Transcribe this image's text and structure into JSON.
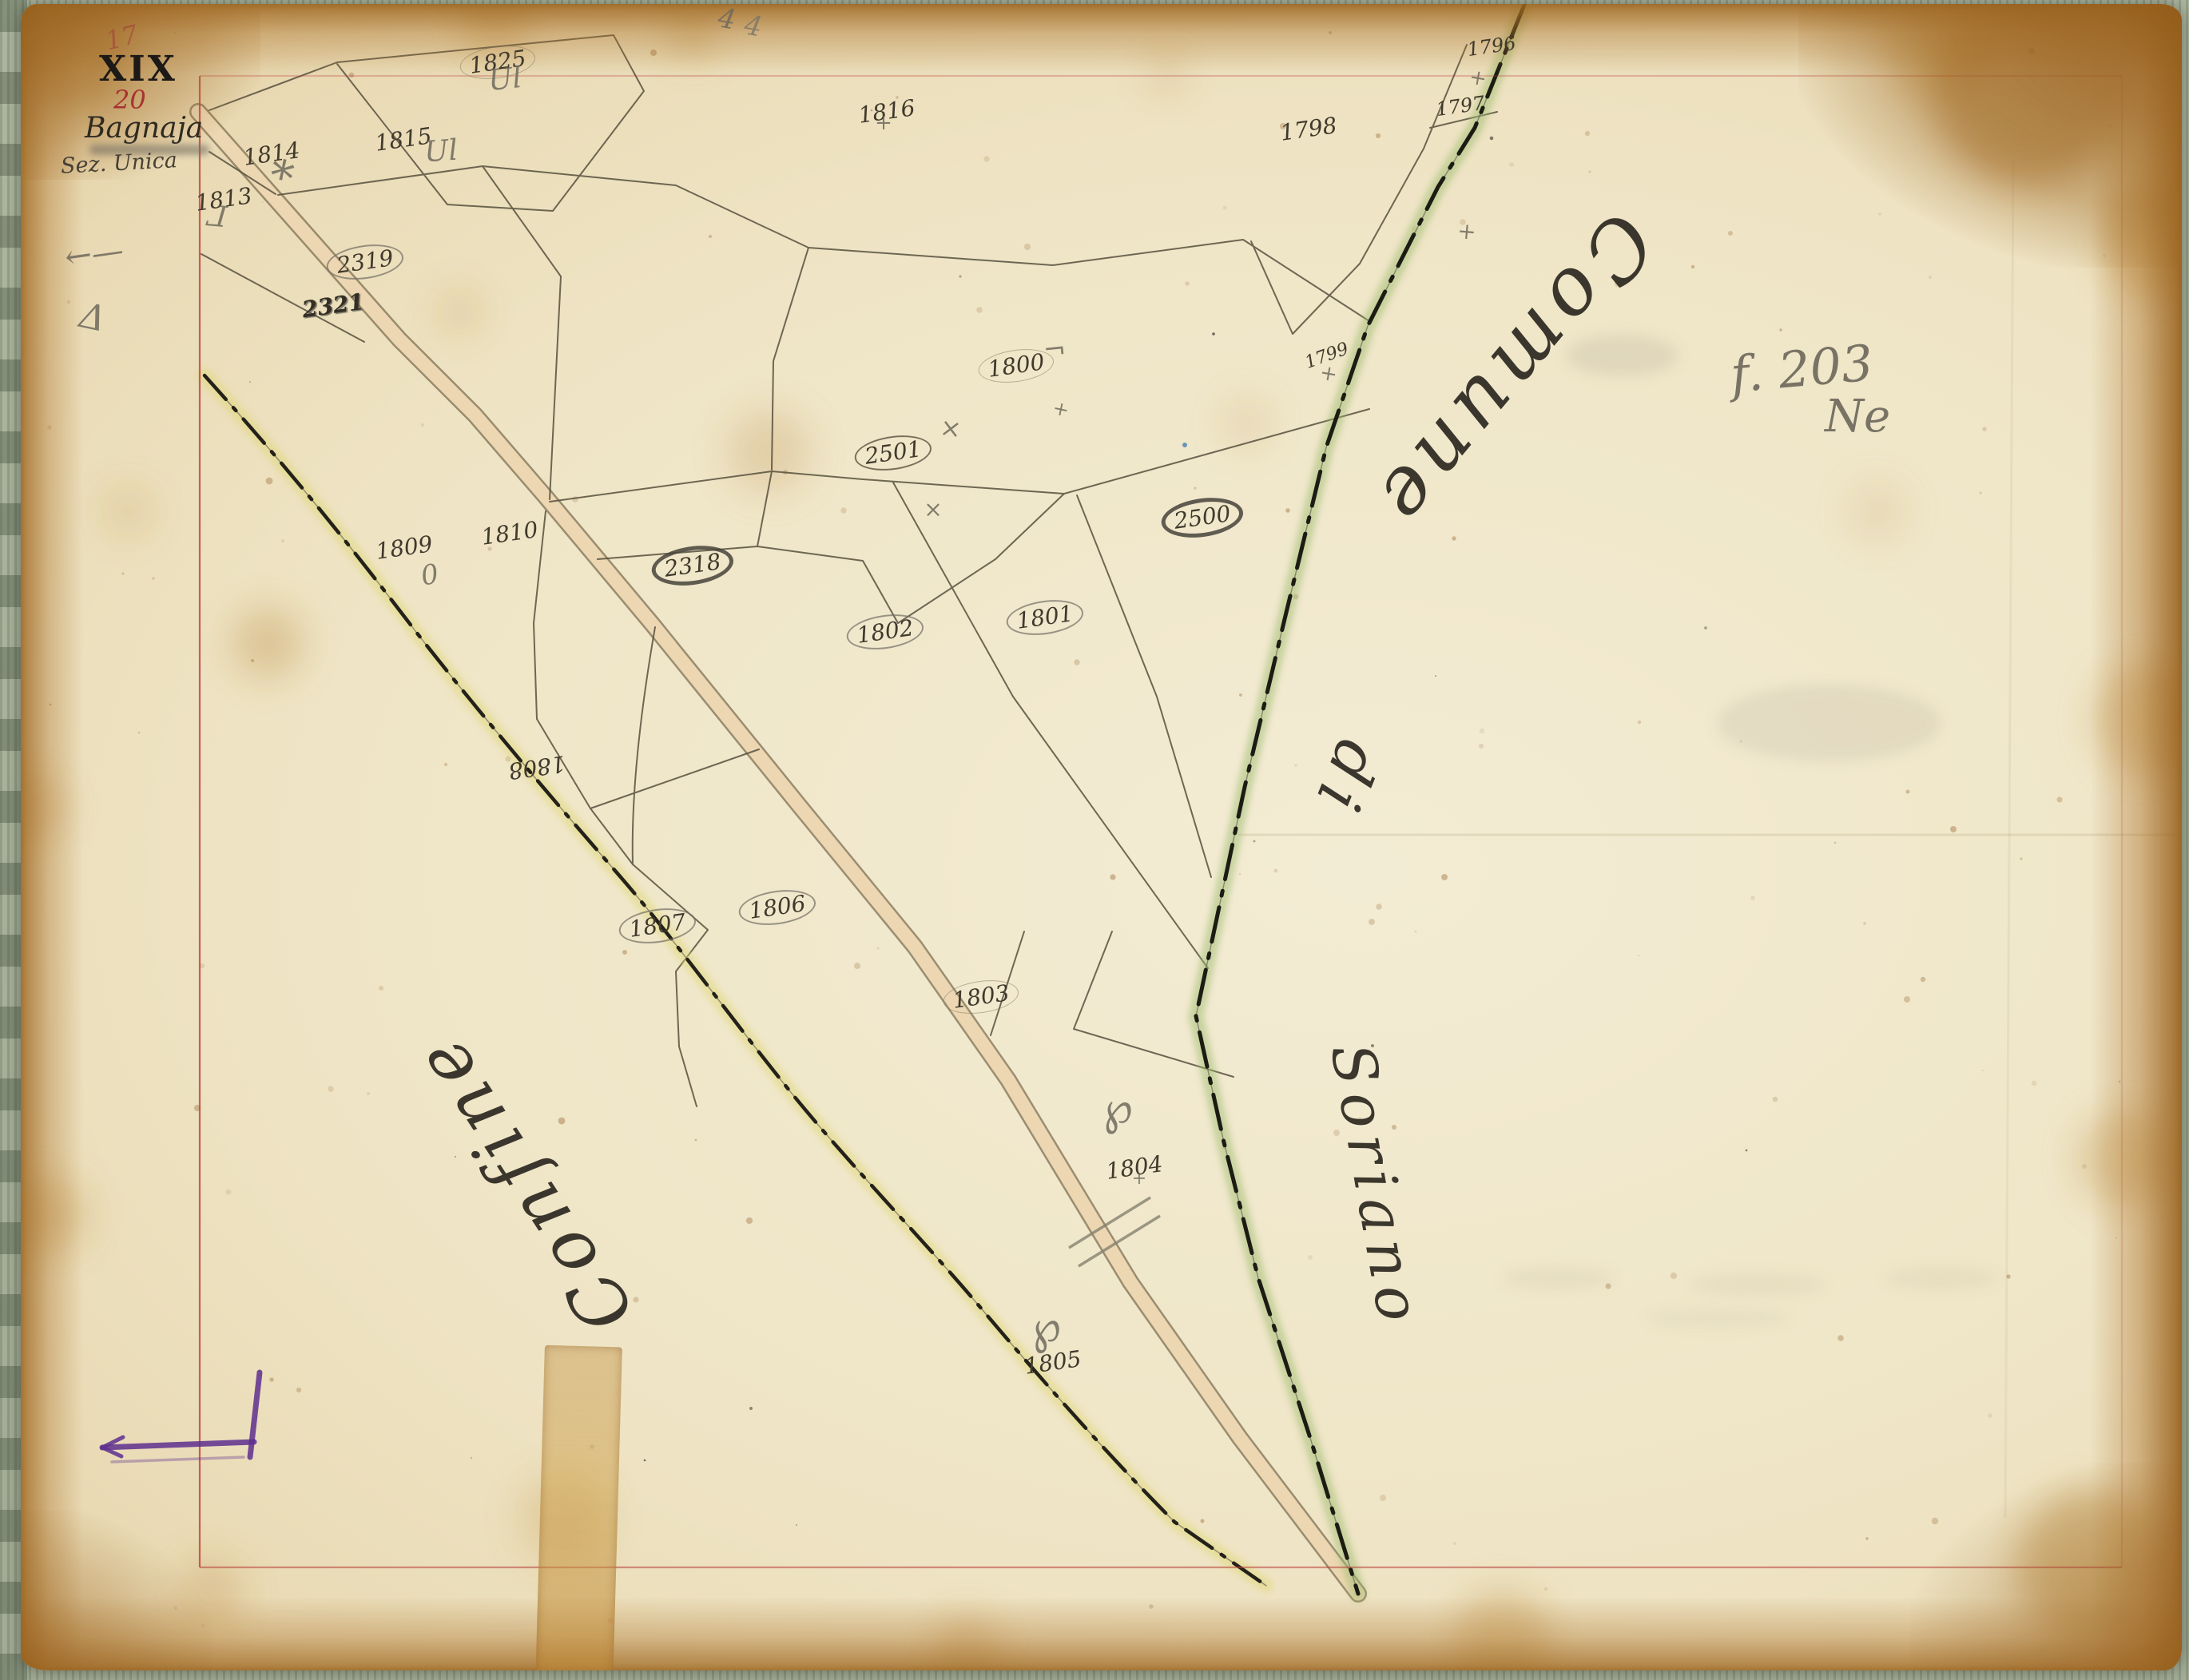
{
  "document_type": "cadastral map sheet (scanned historical document)",
  "corner_block": {
    "folio_number": "17",
    "series": "XIX",
    "sheet_number": "20",
    "title": "Bagnaja",
    "subtitle": "Sez. Unica"
  },
  "notes": {
    "folio_ref": "f. 203",
    "orientation": "Ne",
    "top_edge_mark": "4"
  },
  "map": {
    "territory_labels": [
      {
        "text": "Comune",
        "x": 1895,
        "y": 465,
        "rot": 130,
        "size": 100
      },
      {
        "text": "di",
        "x": 1685,
        "y": 975,
        "rot": 112,
        "size": 78
      },
      {
        "text": "Soriano",
        "x": 1722,
        "y": 1485,
        "rot": 80,
        "size": 74
      },
      {
        "text": "Confine",
        "x": 655,
        "y": 1480,
        "rot": 237,
        "size": 90
      }
    ],
    "parcels": [
      {
        "label": "1825",
        "x": 623,
        "y": 78,
        "circle": "c-ink-faint"
      },
      {
        "label": "1816",
        "x": 1110,
        "y": 140
      },
      {
        "label": "1798",
        "x": 1638,
        "y": 162
      },
      {
        "label": "1796",
        "x": 1867,
        "y": 58,
        "size": 24
      },
      {
        "label": "1797",
        "x": 1828,
        "y": 133,
        "size": 24
      },
      {
        "label": "1799",
        "x": 1661,
        "y": 446,
        "size": 22,
        "rot": -20
      },
      {
        "label": "1800",
        "x": 1272,
        "y": 458,
        "circle": "c-ink-faint"
      },
      {
        "label": "1814",
        "x": 340,
        "y": 193
      },
      {
        "label": "1815",
        "x": 505,
        "y": 175
      },
      {
        "label": "1813",
        "x": 280,
        "y": 250
      },
      {
        "label": "2319",
        "x": 457,
        "y": 328,
        "circle": "c-pencil"
      },
      {
        "label": "2321",
        "x": 417,
        "y": 383,
        "overwritten": true
      },
      {
        "label": "2501",
        "x": 1118,
        "y": 567,
        "circle": "c-ink"
      },
      {
        "label": "2500",
        "x": 1505,
        "y": 648,
        "circle": "c-pencil-dark"
      },
      {
        "label": "1809",
        "x": 506,
        "y": 686
      },
      {
        "label": "1810",
        "x": 638,
        "y": 668
      },
      {
        "label": "2318",
        "x": 867,
        "y": 708,
        "circle": "c-pencil-dark"
      },
      {
        "label": "1802",
        "x": 1108,
        "y": 791,
        "circle": "c-pencil"
      },
      {
        "label": "1801",
        "x": 1308,
        "y": 773,
        "circle": "c-pencil"
      },
      {
        "label": "1808",
        "x": 672,
        "y": 960,
        "rot": 172
      },
      {
        "label": "1807",
        "x": 823,
        "y": 1159,
        "circle": "c-pencil"
      },
      {
        "label": "1806",
        "x": 973,
        "y": 1136,
        "circle": "c-pencil"
      },
      {
        "label": "1803",
        "x": 1228,
        "y": 1248,
        "circle": "c-ink-faint"
      },
      {
        "label": "1804",
        "x": 1420,
        "y": 1462
      },
      {
        "label": "1805",
        "x": 1318,
        "y": 1706
      }
    ],
    "pencil_marks": [
      {
        "type": "asterisk",
        "x": 352,
        "y": 222,
        "size": 58,
        "rot": 12
      },
      {
        "type": "ul",
        "x": 632,
        "y": 100,
        "size": 36,
        "rot": -6
      },
      {
        "type": "ul",
        "x": 552,
        "y": 190,
        "size": 36,
        "rot": -4
      },
      {
        "type": "gamma",
        "x": 272,
        "y": 268,
        "size": 36,
        "rot": 185
      },
      {
        "type": "arrow",
        "x": 118,
        "y": 318,
        "size": 40,
        "rot": -8
      },
      {
        "type": "triangle",
        "x": 116,
        "y": 398,
        "size": 44,
        "rot": 12
      },
      {
        "type": "plus",
        "x": 1106,
        "y": 154,
        "size": 26,
        "rot": 0
      },
      {
        "type": "plus",
        "x": 1850,
        "y": 98,
        "size": 26,
        "rot": 10
      },
      {
        "type": "plus",
        "x": 1836,
        "y": 290,
        "size": 28,
        "rot": 5
      },
      {
        "type": "plus",
        "x": 1663,
        "y": 468,
        "size": 26,
        "rot": 10
      },
      {
        "type": "corner",
        "x": 1320,
        "y": 438,
        "size": 34,
        "rot": -6
      },
      {
        "type": "x",
        "x": 1190,
        "y": 536,
        "size": 32,
        "rot": 8
      },
      {
        "type": "x",
        "x": 1168,
        "y": 638,
        "size": 28,
        "rot": 0
      },
      {
        "type": "plus",
        "x": 1328,
        "y": 512,
        "size": 24,
        "rot": 12
      },
      {
        "type": "zero",
        "x": 538,
        "y": 720,
        "size": 34,
        "rot": -10
      },
      {
        "type": "pflourish",
        "x": 1398,
        "y": 1388,
        "size": 56,
        "rot": -8
      },
      {
        "type": "plus",
        "x": 1426,
        "y": 1476,
        "size": 22,
        "rot": 0
      },
      {
        "type": "pflourish",
        "x": 1308,
        "y": 1662,
        "size": 56,
        "rot": -12
      },
      {
        "type": "four",
        "x": 910,
        "y": 24,
        "size": 34,
        "rot": 10
      }
    ],
    "colors": {
      "paper": "#efe5c6",
      "backing_board": "#a9b29c",
      "edge_browning": "#b5812f",
      "road_fill": "#ecd7b2",
      "boundary_green": "#9dbb6e",
      "boundary_yellow": "#ded773",
      "neatline_red": "#b8423a",
      "ink": "#56503e",
      "pencil": "#85816f",
      "purple_crayon": "#5e2f8f",
      "red_accent": "#a83232"
    }
  }
}
